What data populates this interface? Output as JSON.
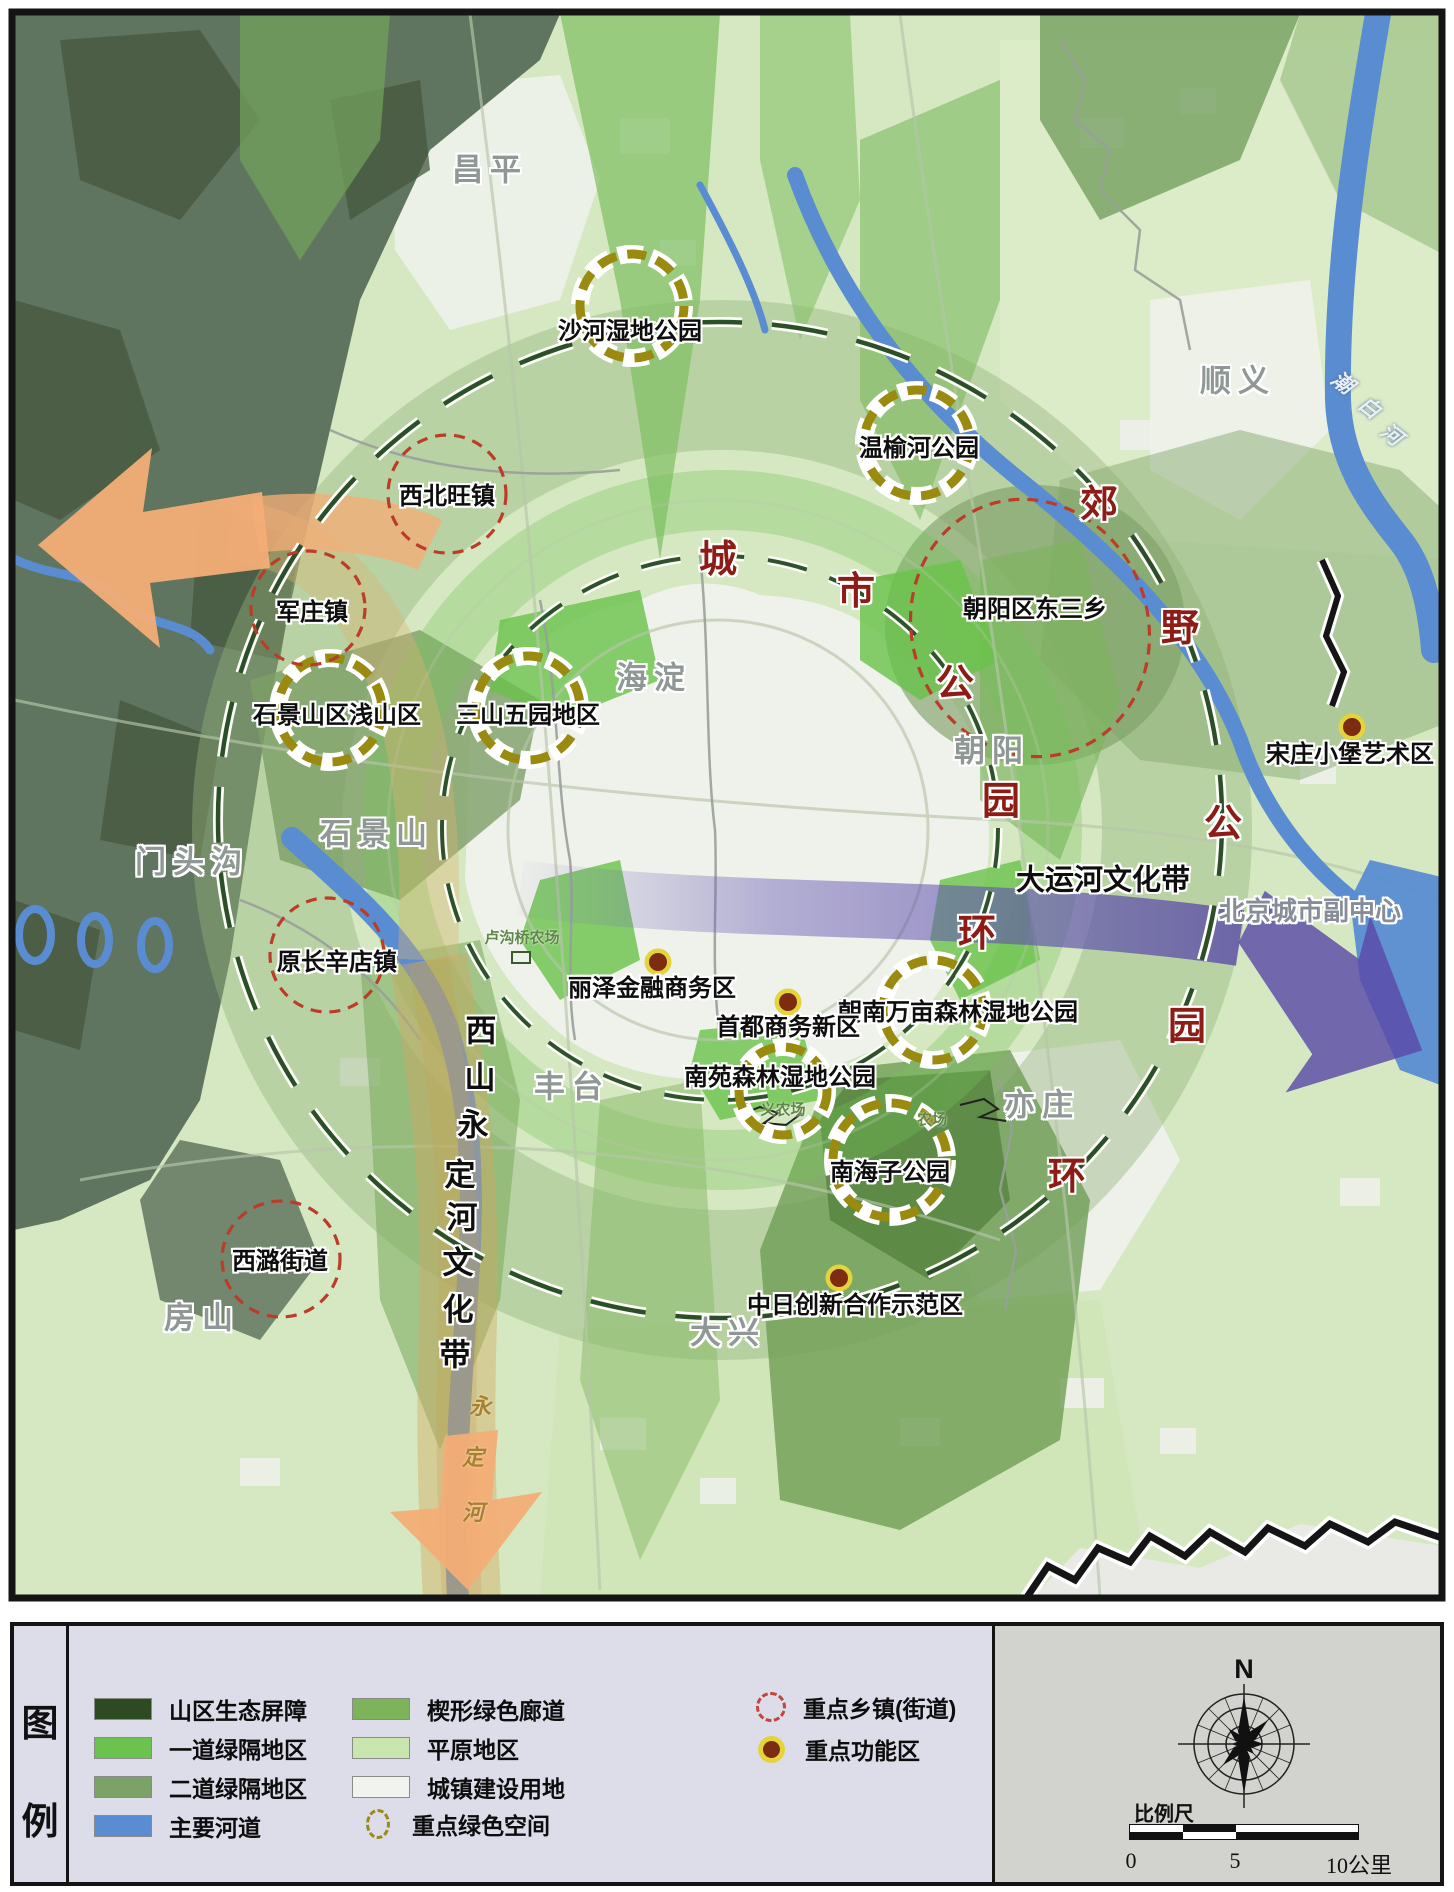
{
  "map": {
    "districts": [
      {
        "text": "昌平",
        "x": 490,
        "y": 170
      },
      {
        "text": "顺义",
        "x": 1238,
        "y": 381
      },
      {
        "text": "海淀",
        "x": 654,
        "y": 678
      },
      {
        "text": "朝阳",
        "x": 992,
        "y": 751
      },
      {
        "text": "石景山",
        "x": 377,
        "y": 834
      },
      {
        "text": "门头沟",
        "x": 192,
        "y": 862
      },
      {
        "text": "丰台",
        "x": 572,
        "y": 1087
      },
      {
        "text": "亦庄",
        "x": 1042,
        "y": 1105
      },
      {
        "text": "房山",
        "x": 202,
        "y": 1318
      },
      {
        "text": "大兴",
        "x": 728,
        "y": 1333
      }
    ],
    "green_spaces": [
      {
        "name": "沙河湿地公园",
        "cx": 632,
        "cy": 306,
        "r": 52,
        "lx": 630,
        "ly": 332
      },
      {
        "name": "温榆河公园",
        "cx": 917,
        "cy": 443,
        "r": 53,
        "lx": 919,
        "ly": 449
      },
      {
        "name": "石景山区浅山区",
        "cx": 330,
        "cy": 710,
        "r": 52,
        "lx": 337,
        "ly": 716
      },
      {
        "name": "三山五园地区",
        "cx": 528,
        "cy": 708,
        "r": 52,
        "lx": 528,
        "ly": 716
      },
      {
        "name": "朝南万亩森林湿地公园",
        "cx": 933,
        "cy": 1010,
        "r": 50,
        "lx": 958,
        "ly": 1013
      },
      {
        "name": "南苑森林湿地公园",
        "cx": 783,
        "cy": 1091,
        "r": 44,
        "lx": 780,
        "ly": 1078
      },
      {
        "name": "南海子公园",
        "cx": 890,
        "cy": 1160,
        "r": 57,
        "lx": 890,
        "ly": 1173
      }
    ],
    "towns": [
      {
        "name": "西北旺镇",
        "cx": 447,
        "cy": 494,
        "rx": 59,
        "ry": 59,
        "rot": 0,
        "lx": 447,
        "ly": 497
      },
      {
        "name": "军庄镇",
        "cx": 308,
        "cy": 608,
        "rx": 57,
        "ry": 57,
        "rot": 0,
        "lx": 312,
        "ly": 613
      },
      {
        "name": "原长辛店镇",
        "cx": 327,
        "cy": 955,
        "rx": 57,
        "ry": 57,
        "rot": 0,
        "lx": 337,
        "ly": 963
      },
      {
        "name": "西潞街道",
        "cx": 281,
        "cy": 1259,
        "rx": 59,
        "ry": 58,
        "rot": 0,
        "lx": 280,
        "ly": 1262
      },
      {
        "name": "朝阳区东三乡",
        "cx": 1030,
        "cy": 628,
        "rx": 118,
        "ry": 130,
        "rot": -20,
        "lx": 1035,
        "ly": 610
      }
    ],
    "functional_zones": [
      {
        "name": "丽泽金融商务区",
        "cx": 658,
        "cy": 962,
        "lx": 652,
        "ly": 989
      },
      {
        "name": "首都商务新区",
        "cx": 788,
        "cy": 1002,
        "lx": 788,
        "ly": 1028
      },
      {
        "name": "宋庄小堡艺术区",
        "cx": 1352,
        "cy": 727,
        "lx": 1350,
        "ly": 755
      },
      {
        "name": "中日创新合作示范区",
        "cx": 839,
        "cy": 1278,
        "lx": 855,
        "ly": 1306
      }
    ],
    "ring_labels": {
      "city_ring_name": "城市公园环",
      "city_ring": [
        {
          "c": "城",
          "x": 718,
          "y": 560
        },
        {
          "c": "市",
          "x": 856,
          "y": 592
        },
        {
          "c": "公",
          "x": 955,
          "y": 684
        },
        {
          "c": "园",
          "x": 1001,
          "y": 802
        },
        {
          "c": "环",
          "x": 977,
          "y": 934
        }
      ],
      "suburban_ring_name": "郊野公园环",
      "suburban_ring": [
        {
          "c": "郊",
          "x": 1099,
          "y": 505
        },
        {
          "c": "野",
          "x": 1180,
          "y": 629
        },
        {
          "c": "公",
          "x": 1223,
          "y": 824
        },
        {
          "c": "园",
          "x": 1187,
          "y": 1027
        },
        {
          "c": "环",
          "x": 1067,
          "y": 1177
        }
      ]
    },
    "corridors": {
      "canal": {
        "text": "大运河文化带",
        "x": 1103,
        "y": 881
      },
      "subcenter": {
        "text": "北京城市副中心",
        "x": 1310,
        "y": 911
      },
      "xishan_band_name": "西山永定河文化带",
      "xishan_band": [
        {
          "c": "西",
          "x": 481,
          "y": 1031
        },
        {
          "c": "山",
          "x": 480,
          "y": 1078
        },
        {
          "c": "永",
          "x": 473,
          "y": 1125
        },
        {
          "c": "定",
          "x": 460,
          "y": 1175
        },
        {
          "c": "河",
          "x": 462,
          "y": 1218
        },
        {
          "c": "文",
          "x": 458,
          "y": 1263
        },
        {
          "c": "化",
          "x": 458,
          "y": 1310
        },
        {
          "c": "带",
          "x": 455,
          "y": 1355
        }
      ],
      "yongding_river_name": "永定河",
      "yongding_river": [
        {
          "c": "永",
          "x": 480,
          "y": 1407
        },
        {
          "c": "定",
          "x": 473,
          "y": 1458
        },
        {
          "c": "河",
          "x": 473,
          "y": 1513
        }
      ],
      "chaobai_river_name": "潮白河",
      "chaobai_river": [
        {
          "c": "潮",
          "x": 1342,
          "y": 383
        },
        {
          "c": "白",
          "x": 1369,
          "y": 408
        },
        {
          "c": "河",
          "x": 1391,
          "y": 435
        }
      ]
    },
    "farms": [
      {
        "text": "卢沟桥农场",
        "x": 522,
        "y": 938
      },
      {
        "text": "义农场",
        "x": 783,
        "y": 1110
      },
      {
        "text": "农场",
        "x": 932,
        "y": 1120
      }
    ]
  },
  "legend": {
    "title_chars": [
      "图",
      "例"
    ],
    "col1": [
      {
        "label": "山区生态屏障",
        "color": "#2e4a21"
      },
      {
        "label": "一道绿隔地区",
        "color": "#6bc24e"
      },
      {
        "label": "二道绿隔地区",
        "color": "#7da267"
      },
      {
        "label": "主要河道",
        "color": "#5a8cd2"
      }
    ],
    "col2": [
      {
        "label": "楔形绿色廊道",
        "color": "#7cb35b"
      },
      {
        "label": "平原地区",
        "color": "#c8e6ae"
      },
      {
        "label": "城镇建设用地",
        "color": "#f1f3ee"
      },
      {
        "label": "重点绿色空间",
        "color": ""
      }
    ],
    "col3": [
      {
        "label": "重点乡镇(街道)"
      },
      {
        "label": "重点功能区"
      }
    ],
    "compass_n": "N",
    "scale_label": "比例尺",
    "scale_ticks": [
      "0",
      "5",
      "10公里"
    ]
  },
  "colors": {
    "plain": "#d5e8c2",
    "urban": "#eef1ea",
    "mountain": "#60755f",
    "wedge": "#7cb35d",
    "river": "#5a8cd2",
    "purple_band": "#5a4ba8",
    "orange_arrow": "#f3ad76",
    "tan_band": "#d8ae67",
    "gold_dash": "#9a8a10",
    "red_dash": "#bb3c28",
    "func_dot": "#7c2c10",
    "func_ring": "#e4d33b",
    "ring_char": "#8c1c15",
    "frame": "#141414"
  }
}
